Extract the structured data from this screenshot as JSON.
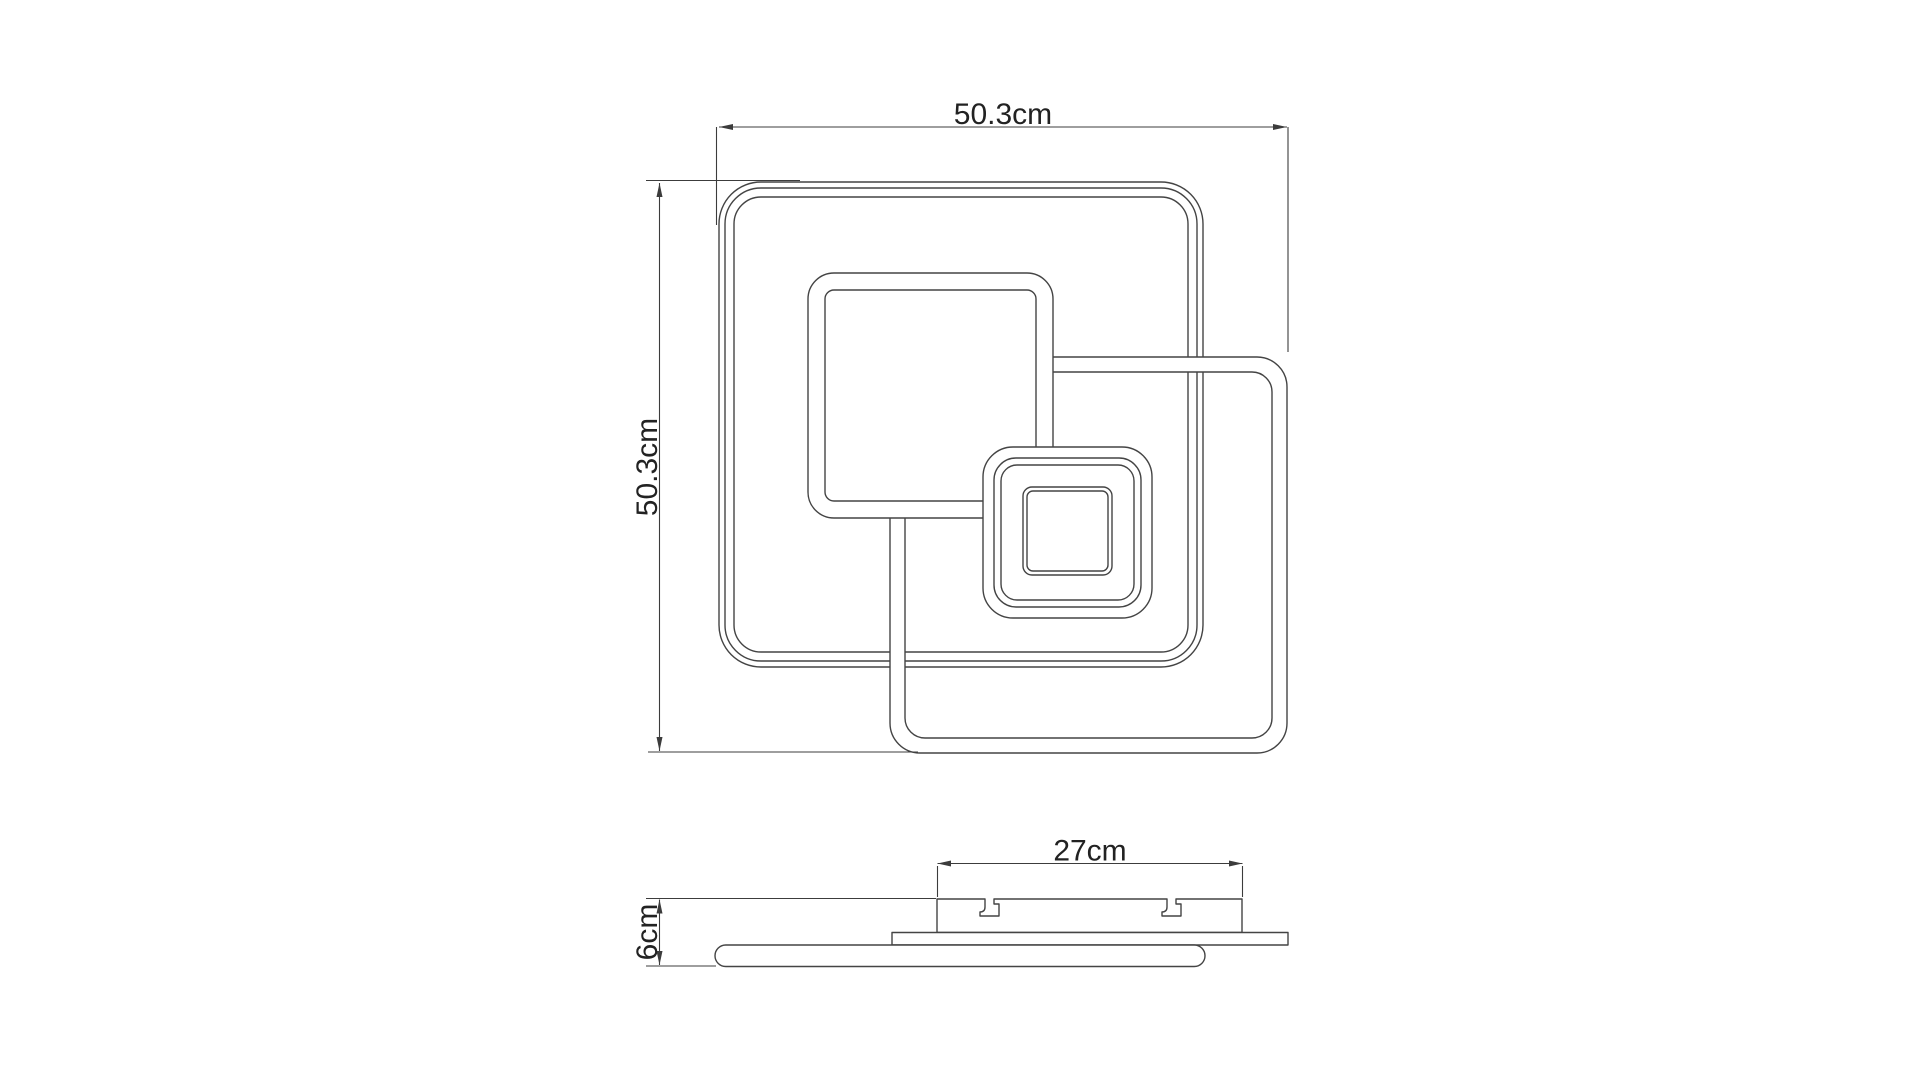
{
  "drawing": {
    "type": "technical-dimension-drawing",
    "background_color": "#ffffff",
    "line_color": "#444444",
    "dimension_line_color": "#3c3c3c",
    "text_color": "#222222",
    "top_view": {
      "description": "plan view of square ceiling light with three overlapping square LED frames and small central square module",
      "width_dim": "50.3cm",
      "height_dim": "50.3cm"
    },
    "side_view": {
      "description": "side profile with ceiling canopy, mounting plate and slim panel",
      "plate_width_dim": "27cm",
      "height_dim": "6cm"
    }
  }
}
